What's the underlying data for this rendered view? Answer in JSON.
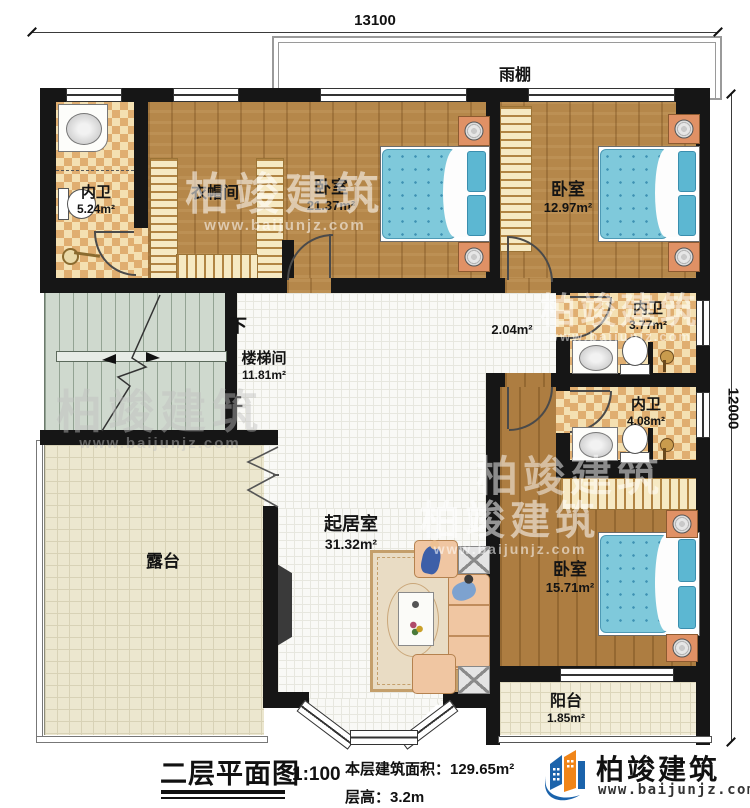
{
  "dimensions": {
    "top_width": "13100",
    "right_height": "12000"
  },
  "canopy": {
    "label": "雨棚"
  },
  "rooms": {
    "bath_top": {
      "name": "内卫",
      "area": "5.24m²"
    },
    "cloakroom": {
      "name": "衣帽间"
    },
    "bedroom_top": {
      "name": "卧室",
      "area": "21.37m²"
    },
    "bedroom_right": {
      "name": "卧室",
      "area": "12.97m²"
    },
    "stairwell": {
      "name": "楼梯间",
      "area": "11.81m²",
      "down": "下",
      "up": "上"
    },
    "hall": {
      "area": "2.04m²"
    },
    "bath_mid": {
      "name": "内卫",
      "area": "3.77m²"
    },
    "bath_low": {
      "name": "内卫",
      "area": "4.08m²"
    },
    "living": {
      "name": "起居室",
      "area": "31.32m²"
    },
    "terrace": {
      "name": "露台"
    },
    "bedroom_low": {
      "name": "卧室",
      "area": "15.71m²"
    },
    "balcony": {
      "name": "阳台",
      "area": "1.85m²"
    }
  },
  "legend": {
    "title": "二层平面图",
    "scale": "1:100",
    "floor_area": "本层建筑面积：129.65m²",
    "floor_height": "层高：3.2m"
  },
  "brand": {
    "name": "柏竣建筑",
    "website": "www.baijunjz.com"
  },
  "watermark": {
    "text": "柏竣建筑",
    "url": "www.baijunjz.com"
  },
  "colors": {
    "wall": "#161616",
    "wood": "#b5874a",
    "tile_checker": "#e0ae70",
    "bed": "#7fc9db",
    "brand_blue": "#1b63ab",
    "brand_orange": "#f08519"
  }
}
